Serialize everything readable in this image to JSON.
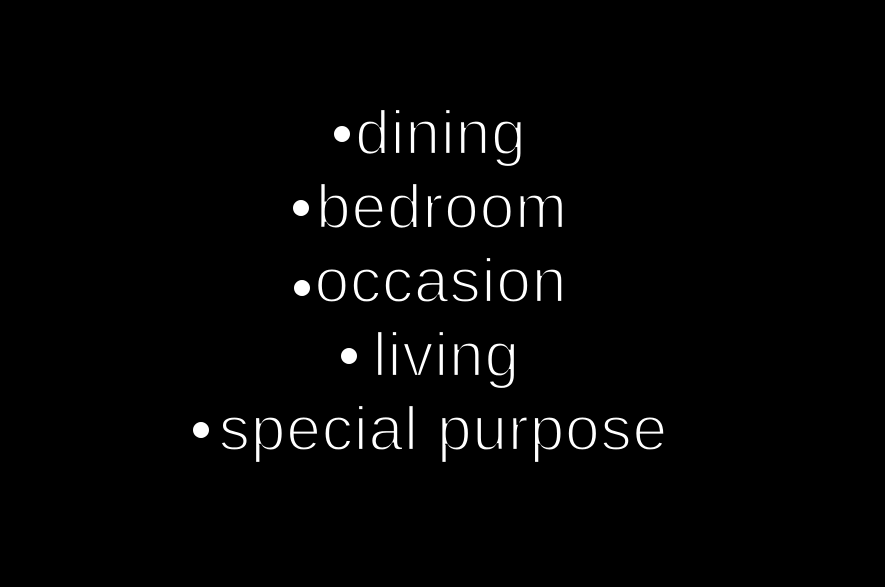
{
  "slide": {
    "background_color": "#000000",
    "text_color": "#ffffff",
    "bullet_items": [
      {
        "label": "dining"
      },
      {
        "label": "bedroom"
      },
      {
        "label": "occasion"
      },
      {
        "label": "living"
      },
      {
        "label": "special purpose"
      }
    ]
  }
}
